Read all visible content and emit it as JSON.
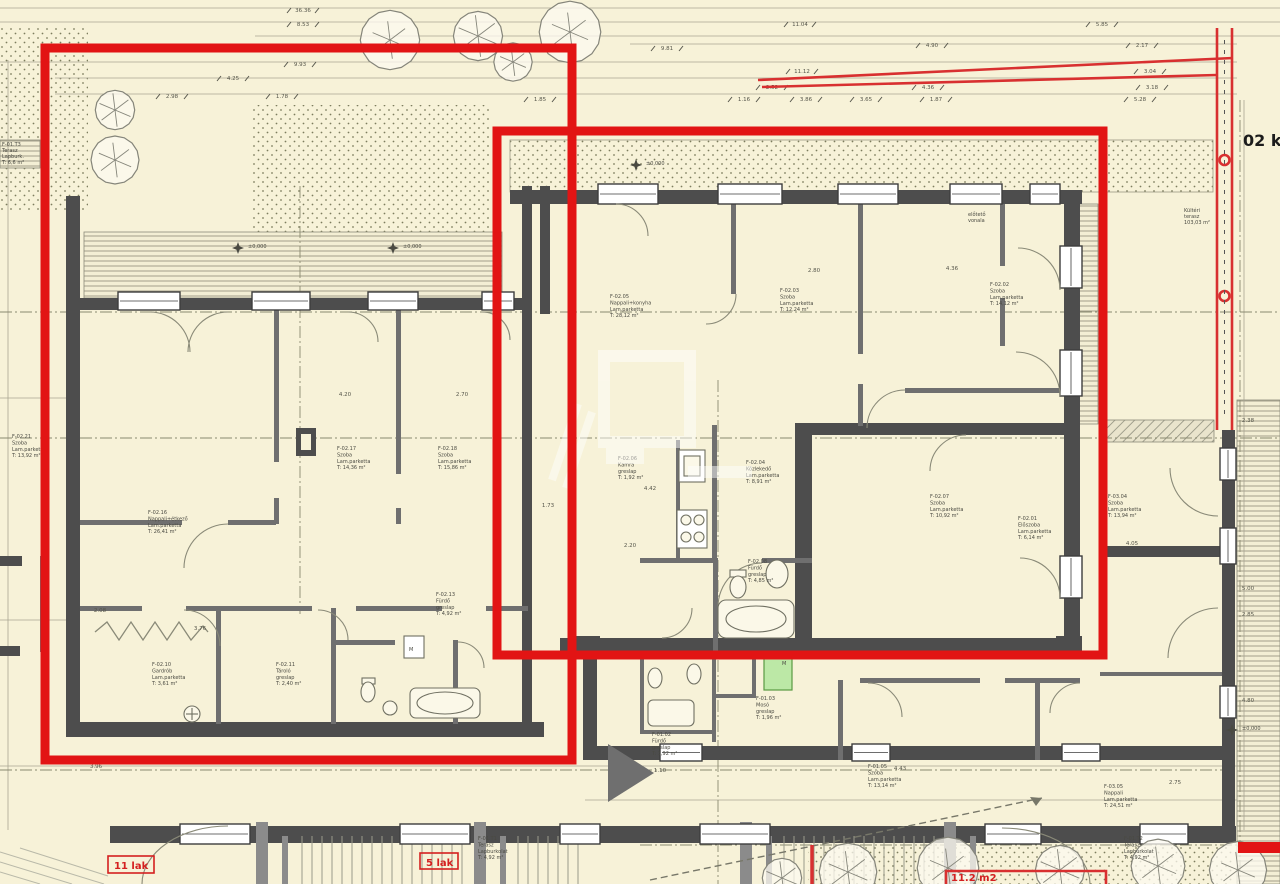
{
  "palette": {
    "background": "#f7f2d8",
    "markup_red": "#e21414",
    "wall_dark": "#4d4d4d",
    "green_highlight": "#bce8a6"
  },
  "corner_note": {
    "text": "02 ke"
  },
  "markup_labels": {
    "unit_left": "11 lak",
    "unit_mid": "5 lak",
    "area_bottom": "11.2 m2"
  },
  "level_marks": [
    {
      "t": "±0,000",
      "x": 252,
      "y": 250
    },
    {
      "t": "±0,000",
      "x": 407,
      "y": 250
    },
    {
      "t": "±0,000",
      "x": 650,
      "y": 167
    },
    {
      "t": "±0,000",
      "x": 1246,
      "y": 732
    }
  ],
  "rooms": [
    {
      "code": "F-02.17",
      "name": "Szoba",
      "floor": "Lam.parketta",
      "area": "T:  14,36 m²",
      "x": 337,
      "y": 450
    },
    {
      "code": "F-02.18",
      "name": "Szoba",
      "floor": "Lam.parketta",
      "area": "T:  15,86 m²",
      "x": 438,
      "y": 450
    },
    {
      "code": "F-02.16",
      "name": "Nappali+étkező",
      "floor": "Lam.parketta",
      "area": "T:  26,41 m²",
      "x": 148,
      "y": 514
    },
    {
      "code": "F-02.10",
      "name": "Gardrób",
      "floor": "Lam.parketta",
      "area": "T:  3,61 m²",
      "x": 152,
      "y": 666
    },
    {
      "code": "F-02.11",
      "name": "Tároló",
      "floor": "greslap",
      "area": "T:  2,40 m²",
      "x": 276,
      "y": 666
    },
    {
      "code": "F-02.13",
      "name": "Fürdő",
      "floor": "greslap",
      "area": "T:  4,92 m²",
      "x": 436,
      "y": 596
    },
    {
      "code": "F-02.05",
      "name": "Nappali+konyha",
      "floor": "Lam.parketta",
      "area": "T:  28,12 m²",
      "x": 610,
      "y": 298
    },
    {
      "code": "F-02.03",
      "name": "Szoba",
      "floor": "Lam.parketta",
      "area": "T:  12,24 m²",
      "x": 780,
      "y": 292
    },
    {
      "code": "F-02.02",
      "name": "Szoba",
      "floor": "Lam.parketta",
      "area": "T:  14,12 m²",
      "x": 990,
      "y": 286
    },
    {
      "code": "F-02.06",
      "name": "Kamra",
      "floor": "greslap",
      "area": "T:  1,92 m²",
      "x": 618,
      "y": 460
    },
    {
      "code": "F-02.04",
      "name": "Közlekedő",
      "floor": "Lam.parketta",
      "area": "T:  8,91 m²",
      "x": 746,
      "y": 464
    },
    {
      "code": "F-02.08",
      "name": "Fürdő",
      "floor": "greslap",
      "area": "T:  4,85 m²",
      "x": 748,
      "y": 563
    },
    {
      "code": "F-02.07",
      "name": "Szoba",
      "floor": "Lam.parketta",
      "area": "T:  10,92 m²",
      "x": 930,
      "y": 498
    },
    {
      "code": "F-02.01",
      "name": "Előszoba",
      "floor": "Lam.parketta",
      "area": "T:  6,14 m²",
      "x": 1018,
      "y": 520
    },
    {
      "code": "F-03.04",
      "name": "Szoba",
      "floor": "Lam.parketta",
      "area": "T:  13,94 m²",
      "x": 1108,
      "y": 498
    },
    {
      "code": "F-03.05",
      "name": "Nappali",
      "floor": "Lam.parketta",
      "area": "T:  24,51 m²",
      "x": 1104,
      "y": 788
    },
    {
      "code": "F-01.05",
      "name": "Szoba",
      "floor": "Lam.parketta",
      "area": "T:  13,14 m²",
      "x": 868,
      "y": 768
    },
    {
      "code": "F-01.02",
      "name": "Fürdő",
      "floor": "greslap",
      "area": "T:  3,92 m²",
      "x": 652,
      "y": 736
    },
    {
      "code": "F-01.03",
      "name": "Mosó",
      "floor": "greslap",
      "area": "T:  1,96 m²",
      "x": 756,
      "y": 700
    },
    {
      "code": "F-01.T1",
      "name": "Terasz",
      "floor": "Lapburkolat",
      "area": "T:  4,92 m²",
      "x": 478,
      "y": 840
    },
    {
      "code": "F-01.T2",
      "name": "Terasz",
      "floor": "Lapburkolat",
      "area": "T:  4,92 m²",
      "x": 1124,
      "y": 840
    },
    {
      "code": "F-02.21",
      "name": "Szoba",
      "floor": "Lam.parketta",
      "area": "T:  13,92 m²",
      "x": 12,
      "y": 438
    }
  ],
  "notes": [
    {
      "x": 968,
      "y": 216,
      "lines": [
        "előtető",
        "vonala"
      ]
    },
    {
      "x": 1184,
      "y": 212,
      "lines": [
        "Kültéri",
        "terasz",
        "103,03 m²"
      ]
    },
    {
      "x": 2,
      "y": 146,
      "lines": [
        "F-01.T3",
        "Terasz",
        "Lapburk.",
        "T: 6,6 m²"
      ]
    }
  ],
  "dimensions": [
    {
      "t": "36.36",
      "x": 303,
      "y": 12
    },
    {
      "t": "8.53",
      "x": 303,
      "y": 26
    },
    {
      "t": "11.04",
      "x": 800,
      "y": 26
    },
    {
      "t": "5.85",
      "x": 1102,
      "y": 26
    },
    {
      "t": "9.93",
      "x": 300,
      "y": 66
    },
    {
      "t": "9.81",
      "x": 667,
      "y": 50
    },
    {
      "t": "4.90",
      "x": 932,
      "y": 47
    },
    {
      "t": "2.17",
      "x": 1142,
      "y": 47
    },
    {
      "t": "11.12",
      "x": 802,
      "y": 73
    },
    {
      "t": "3.04",
      "x": 1150,
      "y": 73
    },
    {
      "t": "4.25",
      "x": 233,
      "y": 80
    },
    {
      "t": "2.52",
      "x": 772,
      "y": 89
    },
    {
      "t": "4.36",
      "x": 928,
      "y": 89
    },
    {
      "t": "3.18",
      "x": 1152,
      "y": 89
    },
    {
      "t": "2.98",
      "x": 172,
      "y": 98
    },
    {
      "t": "1.78",
      "x": 282,
      "y": 98
    },
    {
      "t": "1.16",
      "x": 744,
      "y": 101
    },
    {
      "t": "3.86",
      "x": 806,
      "y": 101
    },
    {
      "t": "3.65",
      "x": 866,
      "y": 101
    },
    {
      "t": "1.87",
      "x": 936,
      "y": 101
    },
    {
      "t": "5.28",
      "x": 1140,
      "y": 101
    },
    {
      "t": "1.85",
      "x": 540,
      "y": 101
    },
    {
      "t": "4.20",
      "x": 345,
      "y": 396
    },
    {
      "t": "2.70",
      "x": 462,
      "y": 396
    },
    {
      "t": "2.80",
      "x": 814,
      "y": 272
    },
    {
      "t": "4.36",
      "x": 952,
      "y": 270
    },
    {
      "t": "4.42",
      "x": 650,
      "y": 490
    },
    {
      "t": "2.20",
      "x": 630,
      "y": 547
    },
    {
      "t": "1.73",
      "x": 548,
      "y": 507
    },
    {
      "t": "2.08",
      "x": 100,
      "y": 612
    },
    {
      "t": "3.76",
      "x": 200,
      "y": 630
    },
    {
      "t": "3.96",
      "x": 96,
      "y": 768
    },
    {
      "t": "1.10",
      "x": 660,
      "y": 772
    },
    {
      "t": "4.43",
      "x": 900,
      "y": 770
    },
    {
      "t": "2.75",
      "x": 1175,
      "y": 784
    },
    {
      "t": "5.00",
      "x": 1248,
      "y": 590
    },
    {
      "t": "2.85",
      "x": 1248,
      "y": 616
    },
    {
      "t": "4.80",
      "x": 1248,
      "y": 702
    },
    {
      "t": "2.38",
      "x": 1248,
      "y": 422
    },
    {
      "t": "4.05",
      "x": 1132,
      "y": 545
    }
  ]
}
